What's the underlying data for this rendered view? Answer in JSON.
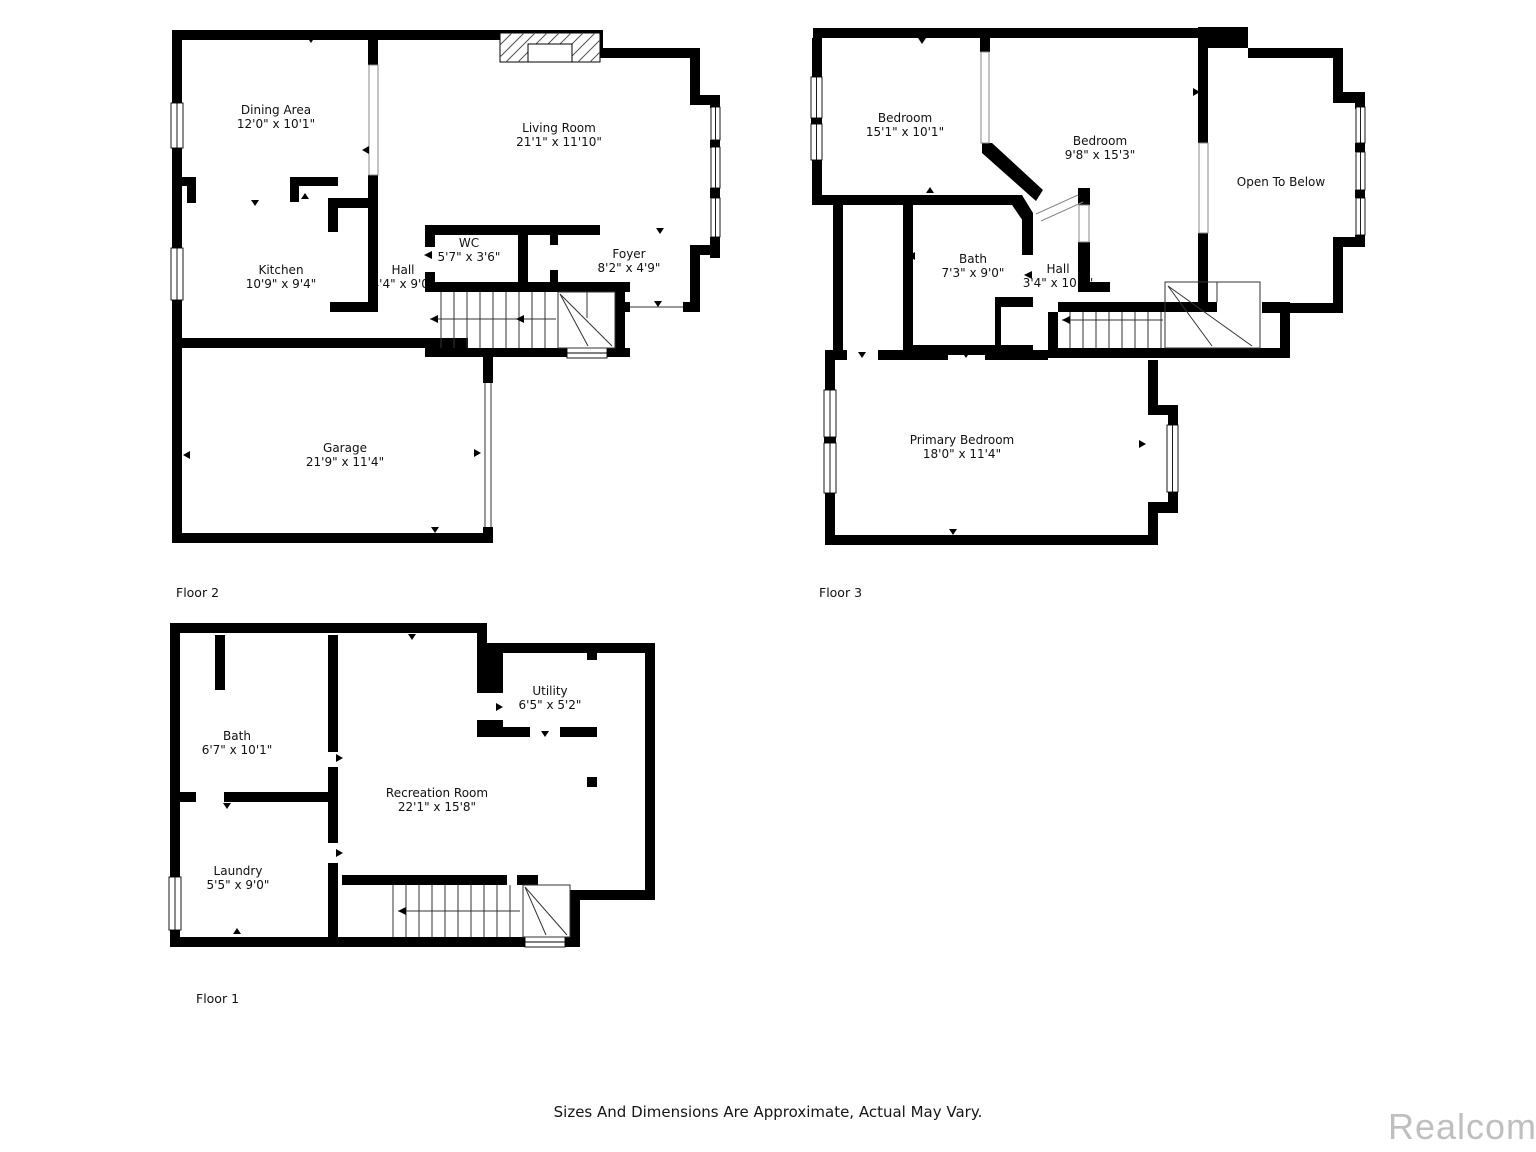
{
  "page": {
    "background": "#ffffff",
    "wall_color": "#000000",
    "footer_disclaimer": "Sizes And Dimensions Are Approximate, Actual May Vary.",
    "watermark": "Realcomp",
    "watermark_color": "#bfbfbf"
  },
  "floors": [
    {
      "label": "Floor 2",
      "rooms": [
        {
          "name": "Dining Area",
          "dims": "12'0\" x 10'1\""
        },
        {
          "name": "Living Room",
          "dims": "21'1\" x 11'10\""
        },
        {
          "name": "Kitchen",
          "dims": "10'9\" x 9'4\""
        },
        {
          "name": "Hall",
          "dims": "4'4\" x 9'0\""
        },
        {
          "name": "WC",
          "dims": "5'7\" x 3'6\""
        },
        {
          "name": "Foyer",
          "dims": "8'2\" x 4'9\""
        },
        {
          "name": "Garage",
          "dims": "21'9\" x 11'4\""
        }
      ]
    },
    {
      "label": "Floor 3",
      "rooms": [
        {
          "name": "Bedroom",
          "dims": "15'1\" x 10'1\""
        },
        {
          "name": "Bedroom",
          "dims": "9'8\" x 15'3\""
        },
        {
          "name": "Open To Below",
          "dims": ""
        },
        {
          "name": "Bath",
          "dims": "7'3\" x 9'0\""
        },
        {
          "name": "Hall",
          "dims": "3'4\" x 10'4\""
        },
        {
          "name": "Primary Bedroom",
          "dims": "18'0\" x 11'4\""
        }
      ]
    },
    {
      "label": "Floor 1",
      "rooms": [
        {
          "name": "Bath",
          "dims": "6'7\" x 10'1\""
        },
        {
          "name": "Utility",
          "dims": "6'5\" x 5'2\""
        },
        {
          "name": "Recreation Room",
          "dims": "22'1\" x 15'8\""
        },
        {
          "name": "Laundry",
          "dims": "5'5\" x 9'0\""
        }
      ]
    }
  ]
}
